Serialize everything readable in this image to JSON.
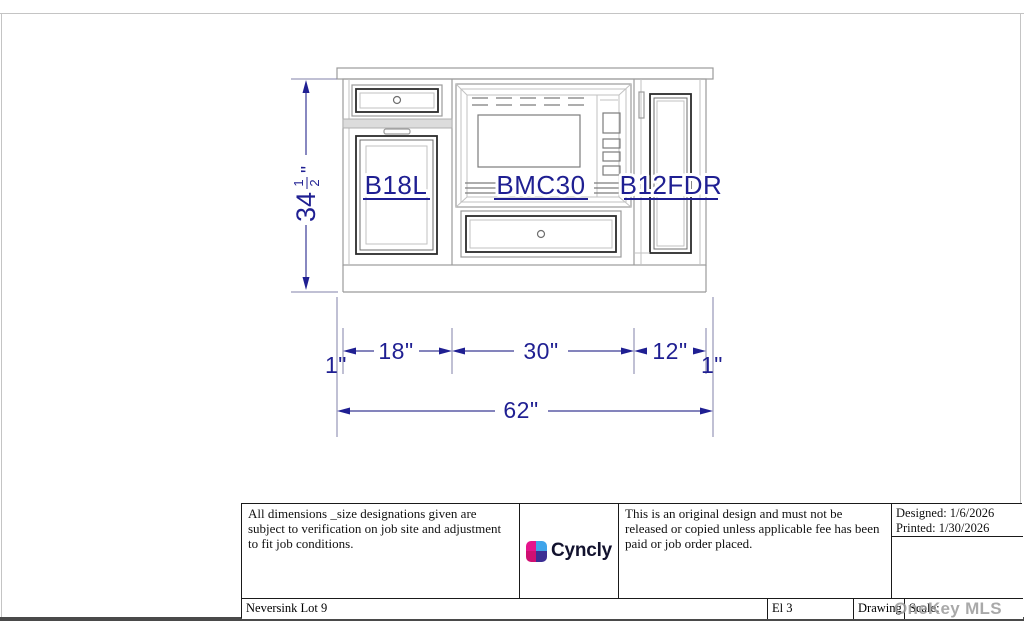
{
  "drawing": {
    "labels": [
      "B18L",
      "BMC30",
      "B12FDR"
    ],
    "dimensions": {
      "height_whole": "34",
      "height_numerator": "1",
      "height_denominator": "2",
      "height_unit": "\"",
      "filler_left": "1\"",
      "cabinet_left": "18\"",
      "cabinet_center": "30\"",
      "cabinet_right": "12\"",
      "filler_right": "1\"",
      "total_width": "62\""
    },
    "colors": {
      "dimension_blue": "#1f1f92",
      "line_gray": "#9b9b9b",
      "frame_dark": "#2b2b2b"
    }
  },
  "title_block": {
    "disclaimer_left": "All dimensions _size designations given are subject to verification on job site and adjustment to fit job conditions.",
    "logo_text": "Cyncly",
    "disclaimer_right": "This is an original design and must not be released or copied unless applicable fee has been paid or job order placed.",
    "designed": "Designed: 1/6/2026",
    "printed": "Printed: 1/30/2026",
    "project": "Neversink Lot 9",
    "elevation": "El 3",
    "drawing_no": "Drawing #:",
    "scale": "Scale:"
  },
  "watermark": {
    "text": "OneKey MLS",
    "color": "#9b9b9b"
  }
}
